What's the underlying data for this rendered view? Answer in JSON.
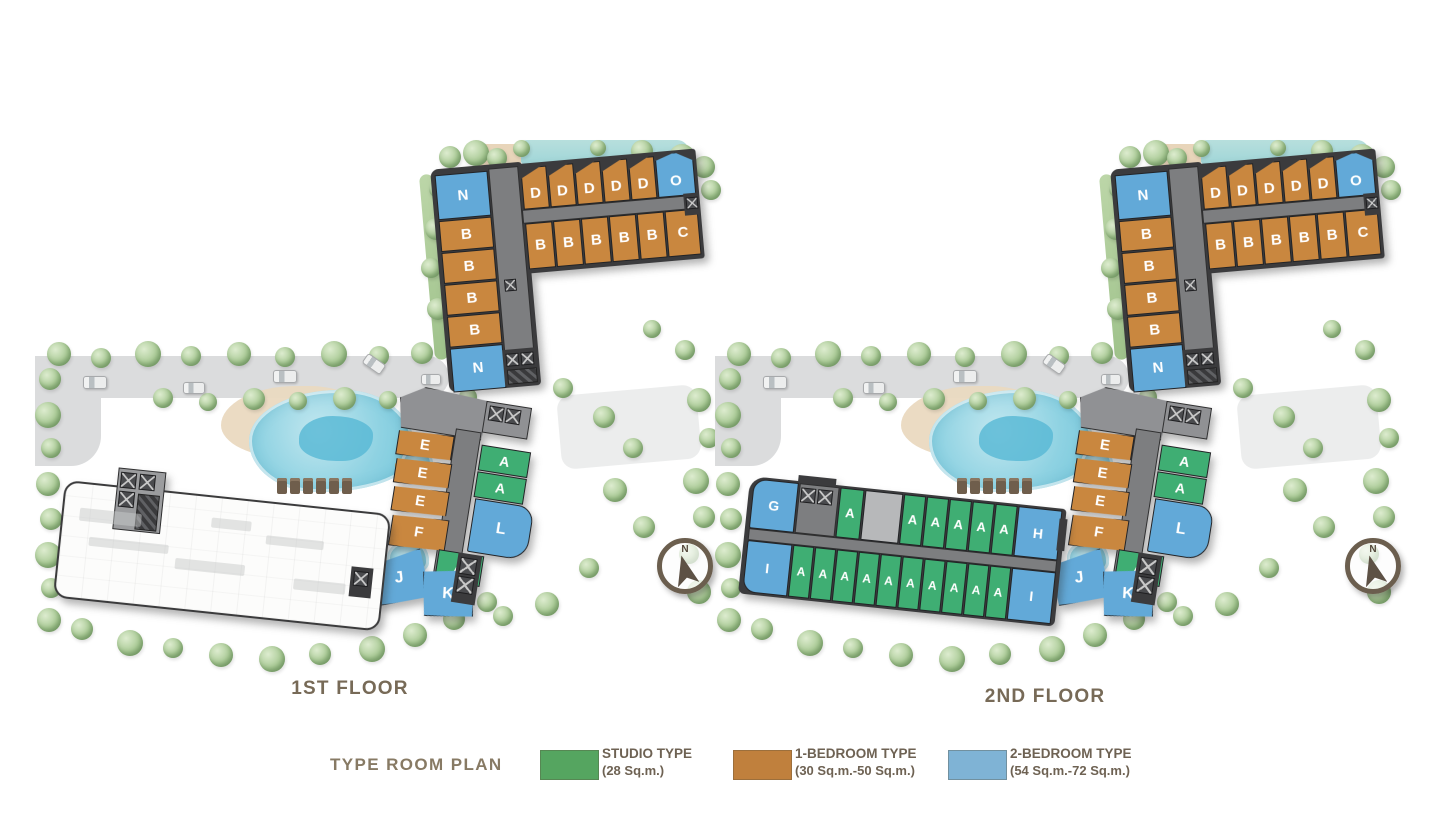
{
  "colors": {
    "studio": "#3fae73",
    "one_bedroom": "#c9873f",
    "two_bedroom": "#62a9d8",
    "blank": "#b7b8ba",
    "corridor": "#7d7e80",
    "core": "#4a4b4e",
    "label_brown": "#776a57"
  },
  "compass": {
    "label": "N"
  },
  "legend": {
    "title": "TYPE ROOM PLAN",
    "items": [
      {
        "label": "STUDIO TYPE",
        "sublabel": "(28 Sq.m.)",
        "color": "#55a560",
        "type": "studio"
      },
      {
        "label": "1-BEDROOM TYPE",
        "sublabel": "(30 Sq.m.-50 Sq.m.)",
        "color": "#c0803d",
        "type": "one_bedroom"
      },
      {
        "label": "2-BEDROOM TYPE",
        "sublabel": "(54 Sq.m.-72 Sq.m.)",
        "color": "#7fb3d5",
        "type": "two_bedroom"
      }
    ]
  },
  "floors": [
    {
      "name": "1st-floor",
      "label": "1ST FLOOR",
      "tower": {
        "left_column": [
          {
            "label": "N",
            "type": "two_bedroom"
          },
          {
            "label": "B",
            "type": "one_bedroom"
          },
          {
            "label": "B",
            "type": "one_bedroom"
          },
          {
            "label": "B",
            "type": "one_bedroom"
          },
          {
            "label": "B",
            "type": "one_bedroom"
          },
          {
            "label": "N",
            "type": "two_bedroom"
          }
        ],
        "top_row": [
          {
            "label": "D",
            "type": "one_bedroom"
          },
          {
            "label": "D",
            "type": "one_bedroom"
          },
          {
            "label": "D",
            "type": "one_bedroom"
          },
          {
            "label": "D",
            "type": "one_bedroom"
          },
          {
            "label": "D",
            "type": "one_bedroom"
          },
          {
            "label": "O",
            "type": "two_bedroom"
          }
        ],
        "mid_row": [
          {
            "label": "B",
            "type": "one_bedroom"
          },
          {
            "label": "B",
            "type": "one_bedroom"
          },
          {
            "label": "B",
            "type": "one_bedroom"
          },
          {
            "label": "B",
            "type": "one_bedroom"
          },
          {
            "label": "B",
            "type": "one_bedroom"
          },
          {
            "label": "C",
            "type": "one_bedroom"
          }
        ]
      },
      "south_building": {
        "left_stack": [
          {
            "label": "E",
            "type": "one_bedroom"
          },
          {
            "label": "E",
            "type": "one_bedroom"
          },
          {
            "label": "E",
            "type": "one_bedroom"
          },
          {
            "label": "F",
            "type": "one_bedroom"
          }
        ],
        "right_stack": [
          {
            "label": "A",
            "type": "studio"
          },
          {
            "label": "A",
            "type": "studio"
          },
          {
            "label": "L",
            "type": "two_bedroom"
          },
          {
            "label": "A",
            "type": "studio"
          }
        ],
        "bottom_row": [
          {
            "label": "J",
            "type": "two_bedroom"
          },
          {
            "label": "K",
            "type": "two_bedroom"
          }
        ]
      }
    },
    {
      "name": "2nd-floor",
      "label": "2ND FLOOR",
      "tower": {
        "left_column": [
          {
            "label": "N",
            "type": "two_bedroom"
          },
          {
            "label": "B",
            "type": "one_bedroom"
          },
          {
            "label": "B",
            "type": "one_bedroom"
          },
          {
            "label": "B",
            "type": "one_bedroom"
          },
          {
            "label": "B",
            "type": "one_bedroom"
          },
          {
            "label": "N",
            "type": "two_bedroom"
          }
        ],
        "top_row": [
          {
            "label": "D",
            "type": "one_bedroom"
          },
          {
            "label": "D",
            "type": "one_bedroom"
          },
          {
            "label": "D",
            "type": "one_bedroom"
          },
          {
            "label": "D",
            "type": "one_bedroom"
          },
          {
            "label": "D",
            "type": "one_bedroom"
          },
          {
            "label": "O",
            "type": "two_bedroom"
          }
        ],
        "mid_row": [
          {
            "label": "B",
            "type": "one_bedroom"
          },
          {
            "label": "B",
            "type": "one_bedroom"
          },
          {
            "label": "B",
            "type": "one_bedroom"
          },
          {
            "label": "B",
            "type": "one_bedroom"
          },
          {
            "label": "B",
            "type": "one_bedroom"
          },
          {
            "label": "C",
            "type": "one_bedroom"
          }
        ]
      },
      "south_building": {
        "left_stack": [
          {
            "label": "E",
            "type": "one_bedroom"
          },
          {
            "label": "E",
            "type": "one_bedroom"
          },
          {
            "label": "E",
            "type": "one_bedroom"
          },
          {
            "label": "F",
            "type": "one_bedroom"
          }
        ],
        "right_stack": [
          {
            "label": "A",
            "type": "studio"
          },
          {
            "label": "A",
            "type": "studio"
          },
          {
            "label": "L",
            "type": "two_bedroom"
          },
          {
            "label": "A",
            "type": "studio"
          }
        ],
        "bottom_row": [
          {
            "label": "J",
            "type": "two_bedroom"
          },
          {
            "label": "K",
            "type": "two_bedroom"
          }
        ]
      },
      "west_wing": {
        "top_row": [
          {
            "label": "G",
            "type": "two_bedroom"
          },
          {
            "label": "A",
            "type": "studio"
          },
          {
            "label": "",
            "type": "blank"
          },
          {
            "label": "A",
            "type": "studio"
          },
          {
            "label": "A",
            "type": "studio"
          },
          {
            "label": "A",
            "type": "studio"
          },
          {
            "label": "A",
            "type": "studio"
          },
          {
            "label": "A",
            "type": "studio"
          },
          {
            "label": "H",
            "type": "two_bedroom"
          }
        ],
        "bottom_row": [
          {
            "label": "I",
            "type": "two_bedroom"
          },
          {
            "label": "A",
            "type": "studio"
          },
          {
            "label": "A",
            "type": "studio"
          },
          {
            "label": "A",
            "type": "studio"
          },
          {
            "label": "A",
            "type": "studio"
          },
          {
            "label": "A",
            "type": "studio"
          },
          {
            "label": "A",
            "type": "studio"
          },
          {
            "label": "A",
            "type": "studio"
          },
          {
            "label": "A",
            "type": "studio"
          },
          {
            "label": "A",
            "type": "studio"
          },
          {
            "label": "A",
            "type": "studio"
          },
          {
            "label": "I",
            "type": "two_bedroom"
          }
        ]
      }
    }
  ]
}
